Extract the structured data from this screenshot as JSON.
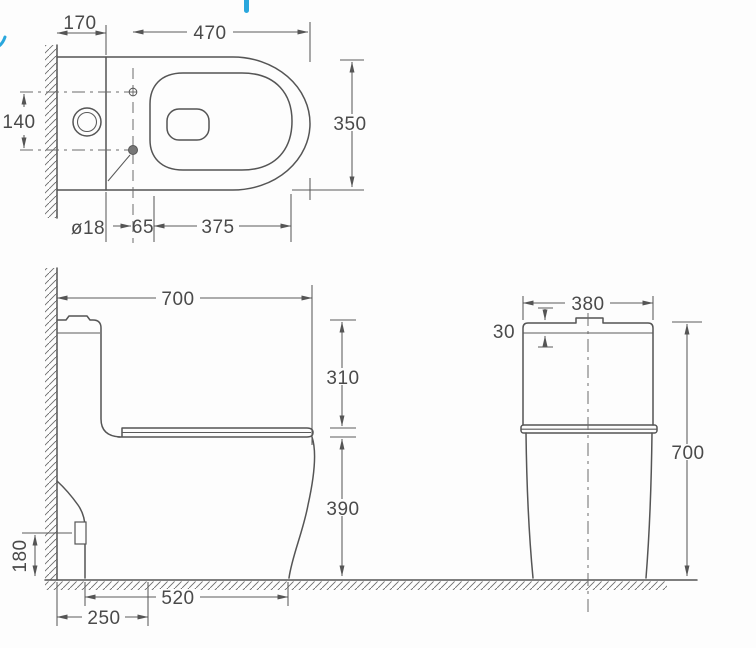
{
  "drawing_colors": {
    "line": "#555555",
    "text": "#4a4a4a",
    "accent_blue": "#2aa7dd"
  },
  "views": {
    "top": {
      "dims": {
        "wall_to_tank_front": "170",
        "tank_front_to_bowl_front": "470",
        "hole_spacing": "140",
        "bowl_width": "350",
        "fixing_hole_diameter": "ø18",
        "hole_to_seat_hinge": "65",
        "seat_opening_length": "375"
      }
    },
    "side": {
      "dims": {
        "overall_depth": "700",
        "tank_top_to_seat": "310",
        "seat_height": "390",
        "outlet_height": "180",
        "base_depth": "520",
        "wall_to_drain": "250"
      }
    },
    "rear": {
      "dims": {
        "tank_width": "380",
        "lid_height": "30",
        "overall_height": "700"
      }
    }
  }
}
